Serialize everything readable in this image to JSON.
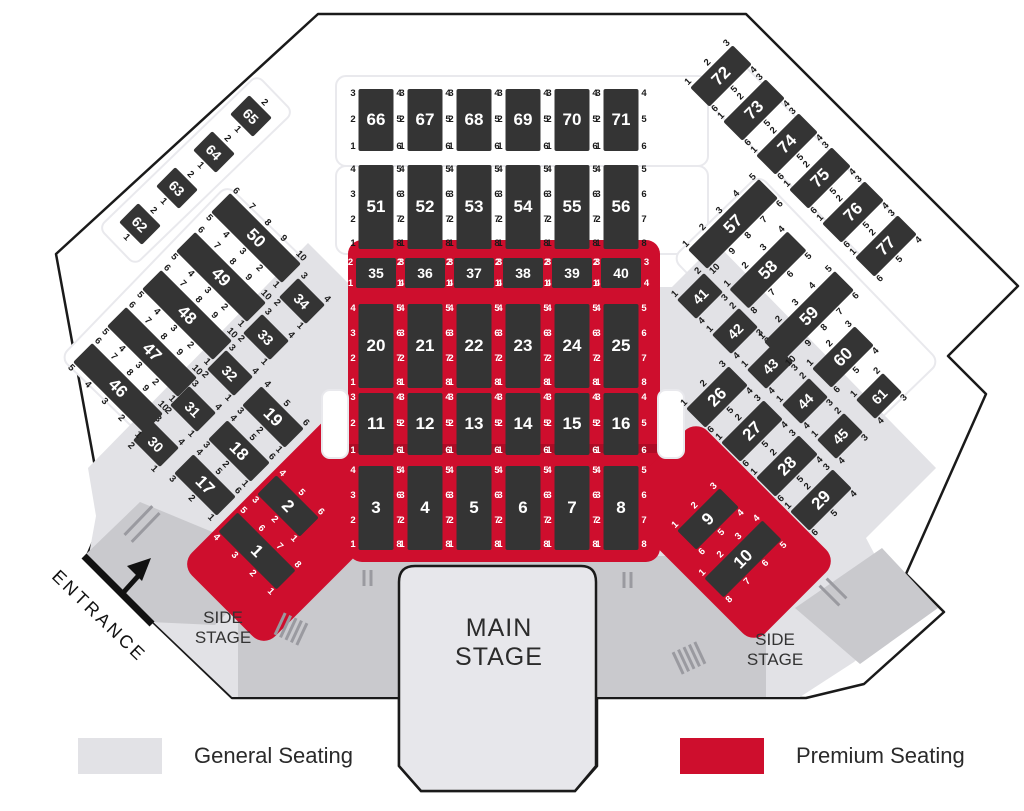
{
  "labels": {
    "main_stage": "MAIN STAGE",
    "side_stage": "SIDE STAGE",
    "entrance": "ENTRANCE"
  },
  "legend": {
    "general_label": "General Seating",
    "premium_label": "Premium Seating"
  },
  "colors": {
    "premium_red": "#ce0e2d",
    "general_gray": "#e2e2e6",
    "walkway_gray": "#c9c9cd",
    "table_block": "#343434",
    "outline_black": "#1a1a1a",
    "stage_fill": "#e7e7eb"
  },
  "tables": [
    {
      "n": "1",
      "x": 257,
      "y": 551,
      "r": 45,
      "o": "h",
      "L": 82,
      "a": [
        "5",
        "6",
        "7",
        "8"
      ],
      "b": [
        "4",
        "3",
        "2",
        "1"
      ],
      "lt": true
    },
    {
      "n": "2",
      "x": 288,
      "y": 506,
      "r": 45,
      "o": "h",
      "L": 60,
      "a": [
        "4",
        "5",
        "6"
      ],
      "b": [
        "3",
        "2",
        "1"
      ],
      "lt": true
    },
    {
      "n": "3",
      "x": 376,
      "y": 508,
      "r": 0,
      "o": "v",
      "L": 84,
      "a": [
        "4",
        "3",
        "2",
        "1"
      ],
      "b": [
        "5",
        "6",
        "7",
        "8"
      ],
      "lt": true
    },
    {
      "n": "4",
      "x": 425,
      "y": 508,
      "r": 0,
      "o": "v",
      "L": 84,
      "a": [
        "4",
        "3",
        "2",
        "1"
      ],
      "b": [
        "5",
        "6",
        "7",
        "8"
      ],
      "lt": true
    },
    {
      "n": "5",
      "x": 474,
      "y": 508,
      "r": 0,
      "o": "v",
      "L": 84,
      "a": [
        "4",
        "3",
        "2",
        "1"
      ],
      "b": [
        "5",
        "6",
        "7",
        "8"
      ],
      "lt": true
    },
    {
      "n": "6",
      "x": 523,
      "y": 508,
      "r": 0,
      "o": "v",
      "L": 84,
      "a": [
        "4",
        "3",
        "2",
        "1"
      ],
      "b": [
        "5",
        "6",
        "7",
        "8"
      ],
      "lt": true
    },
    {
      "n": "7",
      "x": 572,
      "y": 508,
      "r": 0,
      "o": "v",
      "L": 84,
      "a": [
        "4",
        "3",
        "2",
        "1"
      ],
      "b": [
        "5",
        "6",
        "7",
        "8"
      ],
      "lt": true
    },
    {
      "n": "8",
      "x": 621,
      "y": 508,
      "r": 0,
      "o": "v",
      "L": 84,
      "a": [
        "4",
        "3",
        "2",
        "1"
      ],
      "b": [
        "5",
        "6",
        "7",
        "8"
      ],
      "lt": true
    },
    {
      "n": "9",
      "x": 708,
      "y": 519,
      "r": -45,
      "o": "h",
      "L": 60,
      "a": [
        "1",
        "2",
        "3"
      ],
      "b": [
        "6",
        "5",
        "4"
      ],
      "lt": true
    },
    {
      "n": "10",
      "x": 743,
      "y": 559,
      "r": -45,
      "o": "h",
      "L": 82,
      "a": [
        "1",
        "2",
        "3",
        "4"
      ],
      "b": [
        "8",
        "7",
        "6",
        "5"
      ],
      "lt": true
    },
    {
      "n": "11",
      "x": 376,
      "y": 424,
      "r": 0,
      "o": "v",
      "L": 62,
      "a": [
        "3",
        "2",
        "1"
      ],
      "b": [
        "4",
        "5",
        "6"
      ],
      "lt": true
    },
    {
      "n": "12",
      "x": 425,
      "y": 424,
      "r": 0,
      "o": "v",
      "L": 62,
      "a": [
        "3",
        "2",
        "1"
      ],
      "b": [
        "4",
        "5",
        "6"
      ],
      "lt": true
    },
    {
      "n": "13",
      "x": 474,
      "y": 424,
      "r": 0,
      "o": "v",
      "L": 62,
      "a": [
        "3",
        "2",
        "1"
      ],
      "b": [
        "4",
        "5",
        "6"
      ],
      "lt": true
    },
    {
      "n": "14",
      "x": 523,
      "y": 424,
      "r": 0,
      "o": "v",
      "L": 62,
      "a": [
        "3",
        "2",
        "1"
      ],
      "b": [
        "4",
        "5",
        "6"
      ],
      "lt": true
    },
    {
      "n": "15",
      "x": 572,
      "y": 424,
      "r": 0,
      "o": "v",
      "L": 62,
      "a": [
        "3",
        "2",
        "1"
      ],
      "b": [
        "4",
        "5",
        "6"
      ],
      "lt": true
    },
    {
      "n": "16",
      "x": 621,
      "y": 424,
      "r": 0,
      "o": "v",
      "L": 62,
      "a": [
        "3",
        "2",
        "1"
      ],
      "b": [
        "4",
        "5",
        "6"
      ],
      "lt": true
    },
    {
      "n": "17",
      "x": 205,
      "y": 485,
      "r": 45,
      "o": "h",
      "L": 60,
      "a": [
        "4",
        "5",
        "6"
      ],
      "b": [
        "3",
        "2",
        "1"
      ],
      "lt": false
    },
    {
      "n": "18",
      "x": 239,
      "y": 451,
      "r": 45,
      "o": "h",
      "L": 60,
      "a": [
        "4",
        "5",
        "6"
      ],
      "b": [
        "3",
        "2",
        "1"
      ],
      "lt": false
    },
    {
      "n": "19",
      "x": 273,
      "y": 417,
      "r": 45,
      "o": "h",
      "L": 60,
      "a": [
        "4",
        "5",
        "6"
      ],
      "b": [
        "3",
        "2",
        "1"
      ],
      "lt": false
    },
    {
      "n": "20",
      "x": 376,
      "y": 346,
      "r": 0,
      "o": "v",
      "L": 84,
      "a": [
        "4",
        "3",
        "2",
        "1"
      ],
      "b": [
        "5",
        "6",
        "7",
        "8"
      ],
      "lt": true
    },
    {
      "n": "21",
      "x": 425,
      "y": 346,
      "r": 0,
      "o": "v",
      "L": 84,
      "a": [
        "4",
        "3",
        "2",
        "1"
      ],
      "b": [
        "5",
        "6",
        "7",
        "8"
      ],
      "lt": true
    },
    {
      "n": "22",
      "x": 474,
      "y": 346,
      "r": 0,
      "o": "v",
      "L": 84,
      "a": [
        "4",
        "3",
        "2",
        "1"
      ],
      "b": [
        "5",
        "6",
        "7",
        "8"
      ],
      "lt": true
    },
    {
      "n": "23",
      "x": 523,
      "y": 346,
      "r": 0,
      "o": "v",
      "L": 84,
      "a": [
        "4",
        "3",
        "2",
        "1"
      ],
      "b": [
        "5",
        "6",
        "7",
        "8"
      ],
      "lt": true
    },
    {
      "n": "24",
      "x": 572,
      "y": 346,
      "r": 0,
      "o": "v",
      "L": 84,
      "a": [
        "4",
        "3",
        "2",
        "1"
      ],
      "b": [
        "5",
        "6",
        "7",
        "8"
      ],
      "lt": true
    },
    {
      "n": "25",
      "x": 621,
      "y": 346,
      "r": 0,
      "o": "v",
      "L": 84,
      "a": [
        "4",
        "3",
        "2",
        "1"
      ],
      "b": [
        "5",
        "6",
        "7",
        "8"
      ],
      "lt": true
    },
    {
      "n": "26",
      "x": 717,
      "y": 397,
      "r": -45,
      "o": "h",
      "L": 60,
      "a": [
        "1",
        "2",
        "3"
      ],
      "b": [
        "6",
        "5",
        "4"
      ],
      "lt": false
    },
    {
      "n": "27",
      "x": 752,
      "y": 431,
      "r": -45,
      "o": "h",
      "L": 60,
      "a": [
        "1",
        "2",
        "3"
      ],
      "b": [
        "6",
        "5",
        "4"
      ],
      "lt": false
    },
    {
      "n": "28",
      "x": 787,
      "y": 466,
      "r": -45,
      "o": "h",
      "L": 60,
      "a": [
        "1",
        "2",
        "3"
      ],
      "b": [
        "6",
        "5",
        "4"
      ],
      "lt": false
    },
    {
      "n": "29",
      "x": 821,
      "y": 500,
      "r": -45,
      "o": "h",
      "L": 60,
      "a": [
        "1",
        "2",
        "3"
      ],
      "b": [
        "6",
        "5",
        "4"
      ],
      "lt": false
    },
    {
      "n": "30",
      "x": 156,
      "y": 444,
      "r": 45,
      "o": "h",
      "L": 38,
      "a": [
        "3",
        "4"
      ],
      "b": [
        "2",
        "1"
      ],
      "lt": false
    },
    {
      "n": "31",
      "x": 193,
      "y": 409,
      "r": 45,
      "o": "h",
      "L": 38,
      "a": [
        "3",
        "4"
      ],
      "b": [
        "2",
        "1"
      ],
      "lt": false
    },
    {
      "n": "32",
      "x": 230,
      "y": 373,
      "r": 45,
      "o": "h",
      "L": 38,
      "a": [
        "3",
        "4"
      ],
      "b": [
        "2",
        "1"
      ],
      "lt": false
    },
    {
      "n": "33",
      "x": 266,
      "y": 337,
      "r": 45,
      "o": "h",
      "L": 38,
      "a": [
        "3",
        "4"
      ],
      "b": [
        "2",
        "1"
      ],
      "lt": false
    },
    {
      "n": "34",
      "x": 302,
      "y": 301,
      "r": 45,
      "o": "h",
      "L": 38,
      "a": [
        "3",
        "4"
      ],
      "b": [
        "2",
        "1"
      ],
      "lt": false
    },
    {
      "n": "35",
      "x": 376,
      "y": 273,
      "r": 0,
      "o": "v",
      "L": 30,
      "t": 40,
      "a": [
        "2",
        "1"
      ],
      "b": [
        "3",
        "4"
      ],
      "lt": true
    },
    {
      "n": "36",
      "x": 425,
      "y": 273,
      "r": 0,
      "o": "v",
      "L": 30,
      "t": 40,
      "a": [
        "2",
        "1"
      ],
      "b": [
        "3",
        "4"
      ],
      "lt": true
    },
    {
      "n": "37",
      "x": 474,
      "y": 273,
      "r": 0,
      "o": "v",
      "L": 30,
      "t": 40,
      "a": [
        "2",
        "1"
      ],
      "b": [
        "3",
        "4"
      ],
      "lt": true
    },
    {
      "n": "38",
      "x": 523,
      "y": 273,
      "r": 0,
      "o": "v",
      "L": 30,
      "t": 40,
      "a": [
        "2",
        "1"
      ],
      "b": [
        "3",
        "4"
      ],
      "lt": true
    },
    {
      "n": "39",
      "x": 572,
      "y": 273,
      "r": 0,
      "o": "v",
      "L": 30,
      "t": 40,
      "a": [
        "2",
        "1"
      ],
      "b": [
        "3",
        "4"
      ],
      "lt": true
    },
    {
      "n": "40",
      "x": 621,
      "y": 273,
      "r": 0,
      "o": "v",
      "L": 30,
      "t": 40,
      "a": [
        "2",
        "1"
      ],
      "b": [
        "3",
        "4"
      ],
      "lt": true
    },
    {
      "n": "41",
      "x": 700,
      "y": 296,
      "r": -45,
      "o": "h",
      "L": 38,
      "a": [
        "1",
        "2"
      ],
      "b": [
        "4",
        "3"
      ],
      "lt": false
    },
    {
      "n": "42",
      "x": 735,
      "y": 331,
      "r": -45,
      "o": "h",
      "L": 38,
      "a": [
        "1",
        "2"
      ],
      "b": [
        "4",
        "3"
      ],
      "lt": false
    },
    {
      "n": "43",
      "x": 770,
      "y": 366,
      "r": -45,
      "o": "h",
      "L": 38,
      "a": [
        "1",
        "2"
      ],
      "b": [
        "4",
        "3"
      ],
      "lt": false
    },
    {
      "n": "44",
      "x": 805,
      "y": 401,
      "r": -45,
      "o": "h",
      "L": 38,
      "a": [
        "1",
        "2"
      ],
      "b": [
        "4",
        "3"
      ],
      "lt": false
    },
    {
      "n": "45",
      "x": 840,
      "y": 436,
      "r": -45,
      "o": "h",
      "L": 38,
      "a": [
        "1",
        "2"
      ],
      "b": [
        "4",
        "3"
      ],
      "lt": false
    },
    {
      "n": "46",
      "x": 118,
      "y": 388,
      "r": 45,
      "o": "h",
      "L": 100,
      "a": [
        "6",
        "7",
        "8",
        "9",
        "10"
      ],
      "b": [
        "5",
        "4",
        "3",
        "2",
        "1"
      ],
      "lt": false
    },
    {
      "n": "47",
      "x": 152,
      "y": 352,
      "r": 45,
      "o": "h",
      "L": 100,
      "a": [
        "6",
        "7",
        "8",
        "9",
        "10"
      ],
      "b": [
        "5",
        "4",
        "3",
        "2",
        "1"
      ],
      "lt": false
    },
    {
      "n": "48",
      "x": 187,
      "y": 315,
      "r": 45,
      "o": "h",
      "L": 100,
      "a": [
        "6",
        "7",
        "8",
        "9",
        "10"
      ],
      "b": [
        "5",
        "4",
        "3",
        "2",
        "1"
      ],
      "lt": false
    },
    {
      "n": "49",
      "x": 221,
      "y": 277,
      "r": 45,
      "o": "h",
      "L": 100,
      "a": [
        "6",
        "7",
        "8",
        "9",
        "10"
      ],
      "b": [
        "5",
        "4",
        "3",
        "2",
        "1"
      ],
      "lt": false
    },
    {
      "n": "50",
      "x": 256,
      "y": 238,
      "r": 45,
      "o": "h",
      "L": 100,
      "a": [
        "6",
        "7",
        "8",
        "9",
        "10"
      ],
      "b": [
        "5",
        "4",
        "3",
        "2",
        "1"
      ],
      "lt": false
    },
    {
      "n": "51",
      "x": 376,
      "y": 207,
      "r": 0,
      "o": "v",
      "L": 84,
      "a": [
        "4",
        "3",
        "2",
        "1"
      ],
      "b": [
        "5",
        "6",
        "7",
        "8"
      ],
      "lt": false
    },
    {
      "n": "52",
      "x": 425,
      "y": 207,
      "r": 0,
      "o": "v",
      "L": 84,
      "a": [
        "4",
        "3",
        "2",
        "1"
      ],
      "b": [
        "5",
        "6",
        "7",
        "8"
      ],
      "lt": false
    },
    {
      "n": "53",
      "x": 474,
      "y": 207,
      "r": 0,
      "o": "v",
      "L": 84,
      "a": [
        "4",
        "3",
        "2",
        "1"
      ],
      "b": [
        "5",
        "6",
        "7",
        "8"
      ],
      "lt": false
    },
    {
      "n": "54",
      "x": 523,
      "y": 207,
      "r": 0,
      "o": "v",
      "L": 84,
      "a": [
        "4",
        "3",
        "2",
        "1"
      ],
      "b": [
        "5",
        "6",
        "7",
        "8"
      ],
      "lt": false
    },
    {
      "n": "55",
      "x": 572,
      "y": 207,
      "r": 0,
      "o": "v",
      "L": 84,
      "a": [
        "4",
        "3",
        "2",
        "1"
      ],
      "b": [
        "5",
        "6",
        "7",
        "8"
      ],
      "lt": false
    },
    {
      "n": "56",
      "x": 621,
      "y": 207,
      "r": 0,
      "o": "v",
      "L": 84,
      "a": [
        "4",
        "3",
        "2",
        "1"
      ],
      "b": [
        "5",
        "6",
        "7",
        "8"
      ],
      "lt": false
    },
    {
      "n": "57",
      "x": 733,
      "y": 224,
      "r": -45,
      "o": "h",
      "L": 100,
      "a": [
        "1",
        "2",
        "3",
        "4",
        "5"
      ],
      "b": [
        "10",
        "9",
        "8",
        "7",
        "6"
      ],
      "lt": false
    },
    {
      "n": "58",
      "x": 768,
      "y": 270,
      "r": -45,
      "o": "h",
      "L": 82,
      "a": [
        "1",
        "2",
        "3",
        "4"
      ],
      "b": [
        "8",
        "7",
        "6",
        "5"
      ],
      "lt": false
    },
    {
      "n": "59",
      "x": 809,
      "y": 316,
      "r": -45,
      "o": "h",
      "L": 100,
      "a": [
        "1",
        "2",
        "3",
        "4",
        "5"
      ],
      "b": [
        "10",
        "9",
        "8",
        "7",
        "6"
      ],
      "lt": false
    },
    {
      "n": "60",
      "x": 843,
      "y": 357,
      "r": -45,
      "o": "h",
      "L": 60,
      "a": [
        "1",
        "2",
        "3"
      ],
      "b": [
        "6",
        "5",
        "4"
      ],
      "lt": false
    },
    {
      "n": "61",
      "x": 879,
      "y": 396,
      "r": -45,
      "o": "h",
      "L": 38,
      "a": [
        "1",
        "2"
      ],
      "b": [
        "4",
        "3"
      ],
      "lt": false
    },
    {
      "n": "62",
      "x": 140,
      "y": 224,
      "r": 45,
      "o": "h",
      "L": 32,
      "a": [
        "2"
      ],
      "b": [
        "1"
      ],
      "lt": false
    },
    {
      "n": "63",
      "x": 177,
      "y": 188,
      "r": 45,
      "o": "h",
      "L": 32,
      "a": [
        "2"
      ],
      "b": [
        "1"
      ],
      "lt": false
    },
    {
      "n": "64",
      "x": 214,
      "y": 152,
      "r": 45,
      "o": "h",
      "L": 32,
      "a": [
        "2"
      ],
      "b": [
        "1"
      ],
      "lt": false
    },
    {
      "n": "65",
      "x": 251,
      "y": 116,
      "r": 45,
      "o": "h",
      "L": 32,
      "a": [
        "2"
      ],
      "b": [
        "1"
      ],
      "lt": false
    },
    {
      "n": "66",
      "x": 376,
      "y": 120,
      "r": 0,
      "o": "v",
      "L": 62,
      "a": [
        "3",
        "2",
        "1"
      ],
      "b": [
        "4",
        "5",
        "6"
      ],
      "lt": false
    },
    {
      "n": "67",
      "x": 425,
      "y": 120,
      "r": 0,
      "o": "v",
      "L": 62,
      "a": [
        "3",
        "2",
        "1"
      ],
      "b": [
        "4",
        "5",
        "6"
      ],
      "lt": false
    },
    {
      "n": "68",
      "x": 474,
      "y": 120,
      "r": 0,
      "o": "v",
      "L": 62,
      "a": [
        "3",
        "2",
        "1"
      ],
      "b": [
        "4",
        "5",
        "6"
      ],
      "lt": false
    },
    {
      "n": "69",
      "x": 523,
      "y": 120,
      "r": 0,
      "o": "v",
      "L": 62,
      "a": [
        "3",
        "2",
        "1"
      ],
      "b": [
        "4",
        "5",
        "6"
      ],
      "lt": false
    },
    {
      "n": "70",
      "x": 572,
      "y": 120,
      "r": 0,
      "o": "v",
      "L": 62,
      "a": [
        "3",
        "2",
        "1"
      ],
      "b": [
        "4",
        "5",
        "6"
      ],
      "lt": false
    },
    {
      "n": "71",
      "x": 621,
      "y": 120,
      "r": 0,
      "o": "v",
      "L": 62,
      "a": [
        "3",
        "2",
        "1"
      ],
      "b": [
        "4",
        "5",
        "6"
      ],
      "lt": false
    },
    {
      "n": "72",
      "x": 721,
      "y": 76,
      "r": -45,
      "o": "h",
      "L": 60,
      "a": [
        "1",
        "2",
        "3"
      ],
      "b": [
        "6",
        "5",
        "4"
      ],
      "lt": false
    },
    {
      "n": "73",
      "x": 754,
      "y": 110,
      "r": -45,
      "o": "h",
      "L": 60,
      "a": [
        "1",
        "2",
        "3"
      ],
      "b": [
        "6",
        "5",
        "4"
      ],
      "lt": false
    },
    {
      "n": "74",
      "x": 787,
      "y": 144,
      "r": -45,
      "o": "h",
      "L": 60,
      "a": [
        "1",
        "2",
        "3"
      ],
      "b": [
        "6",
        "5",
        "4"
      ],
      "lt": false
    },
    {
      "n": "75",
      "x": 820,
      "y": 178,
      "r": -45,
      "o": "h",
      "L": 60,
      "a": [
        "1",
        "2",
        "3"
      ],
      "b": [
        "6",
        "5",
        "4"
      ],
      "lt": false
    },
    {
      "n": "76",
      "x": 853,
      "y": 212,
      "r": -45,
      "o": "h",
      "L": 60,
      "a": [
        "1",
        "2",
        "3"
      ],
      "b": [
        "6",
        "5",
        "4"
      ],
      "lt": false
    },
    {
      "n": "77",
      "x": 886,
      "y": 246,
      "r": -45,
      "o": "h",
      "L": 60,
      "a": [
        "1",
        "2",
        "3"
      ],
      "b": [
        "6",
        "5",
        "4"
      ],
      "lt": false
    }
  ]
}
